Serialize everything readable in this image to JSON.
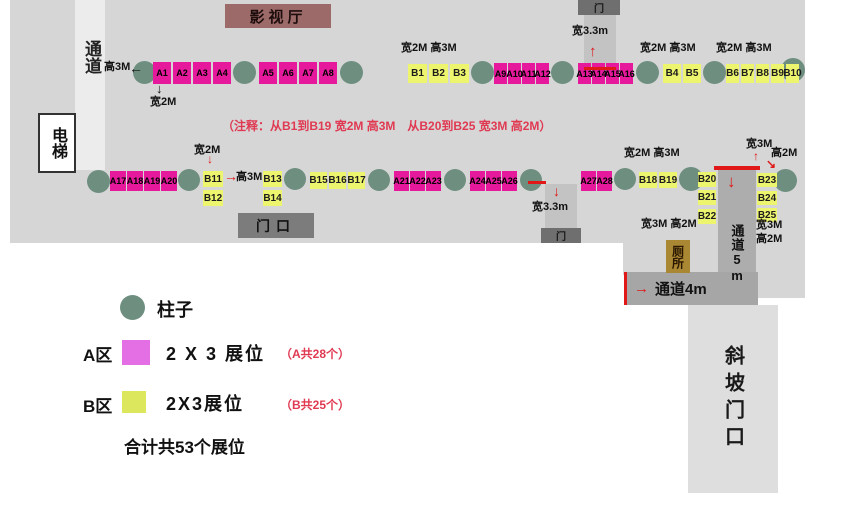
{
  "palette": {
    "booth_a": "#e6189b",
    "booth_b": "#edf46d",
    "pillar": "#6e8f80",
    "red_accent": "#e01818",
    "note_red": "#e03a52",
    "floor_gray": "#d6d6d6"
  },
  "rooms": {
    "cinema": {
      "label": "影视厅"
    },
    "elevator": {
      "label": "电梯"
    },
    "corridor_left": {
      "label": "通道"
    },
    "entrance": {
      "label": "门口"
    },
    "door_top": {
      "label": "门"
    },
    "door_bottom": {
      "label": "门"
    },
    "corridor_5m": {
      "label": "通道5m"
    },
    "corridor_4m": {
      "label": "通道4m"
    },
    "toilet": {
      "label": "厕所"
    },
    "ramp": {
      "label": "斜坡门口"
    }
  },
  "note": "（注释：从B1到B19 宽2M 高3M　从B20到B25 宽3M 高2M）",
  "legend": {
    "pillar_label": "柱子",
    "a_zone": "A区",
    "a_size": "2 X 3 展位",
    "a_count": "（A共28个）",
    "b_zone": "B区",
    "b_size": "2X3展位",
    "b_count": "（B共25个）",
    "total": "合计共53个展位"
  },
  "booths": [
    {
      "id": "A1",
      "x": 153,
      "y": 62,
      "w": 18,
      "h": 22,
      "zone": "A"
    },
    {
      "id": "A2",
      "x": 173,
      "y": 62,
      "w": 18,
      "h": 22,
      "zone": "A"
    },
    {
      "id": "A3",
      "x": 193,
      "y": 62,
      "w": 18,
      "h": 22,
      "zone": "A"
    },
    {
      "id": "A4",
      "x": 213,
      "y": 62,
      "w": 18,
      "h": 22,
      "zone": "A"
    },
    {
      "id": "A5",
      "x": 259,
      "y": 62,
      "w": 18,
      "h": 22,
      "zone": "A"
    },
    {
      "id": "A6",
      "x": 279,
      "y": 62,
      "w": 18,
      "h": 22,
      "zone": "A"
    },
    {
      "id": "A7",
      "x": 299,
      "y": 62,
      "w": 18,
      "h": 22,
      "zone": "A"
    },
    {
      "id": "A8",
      "x": 319,
      "y": 62,
      "w": 18,
      "h": 22,
      "zone": "A"
    },
    {
      "id": "B1",
      "x": 408,
      "y": 64,
      "w": 19,
      "h": 19,
      "zone": "B"
    },
    {
      "id": "B2",
      "x": 429,
      "y": 64,
      "w": 19,
      "h": 19,
      "zone": "B"
    },
    {
      "id": "B3",
      "x": 450,
      "y": 64,
      "w": 19,
      "h": 19,
      "zone": "B"
    },
    {
      "id": "A9",
      "x": 494,
      "y": 63,
      "w": 13,
      "h": 21,
      "zone": "A"
    },
    {
      "id": "A10",
      "x": 508,
      "y": 63,
      "w": 13,
      "h": 21,
      "zone": "A"
    },
    {
      "id": "A11",
      "x": 522,
      "y": 63,
      "w": 13,
      "h": 21,
      "zone": "A"
    },
    {
      "id": "A12",
      "x": 536,
      "y": 63,
      "w": 13,
      "h": 21,
      "zone": "A"
    },
    {
      "id": "A13",
      "x": 578,
      "y": 63,
      "w": 13,
      "h": 21,
      "zone": "A"
    },
    {
      "id": "A14",
      "x": 592,
      "y": 63,
      "w": 13,
      "h": 21,
      "zone": "A"
    },
    {
      "id": "A15",
      "x": 606,
      "y": 63,
      "w": 13,
      "h": 21,
      "zone": "A"
    },
    {
      "id": "A16",
      "x": 620,
      "y": 63,
      "w": 13,
      "h": 21,
      "zone": "A"
    },
    {
      "id": "B4",
      "x": 663,
      "y": 64,
      "w": 18,
      "h": 19,
      "zone": "B"
    },
    {
      "id": "B5",
      "x": 683,
      "y": 64,
      "w": 18,
      "h": 19,
      "zone": "B"
    },
    {
      "id": "B6",
      "x": 726,
      "y": 64,
      "w": 13,
      "h": 19,
      "zone": "B"
    },
    {
      "id": "B7",
      "x": 741,
      "y": 64,
      "w": 13,
      "h": 19,
      "zone": "B"
    },
    {
      "id": "B8",
      "x": 756,
      "y": 64,
      "w": 13,
      "h": 19,
      "zone": "B"
    },
    {
      "id": "B9",
      "x": 771,
      "y": 64,
      "w": 13,
      "h": 19,
      "zone": "B"
    },
    {
      "id": "B10",
      "x": 786,
      "y": 64,
      "w": 13,
      "h": 19,
      "zone": "B"
    },
    {
      "id": "A17",
      "x": 110,
      "y": 171,
      "w": 16,
      "h": 20,
      "zone": "A"
    },
    {
      "id": "A18",
      "x": 127,
      "y": 171,
      "w": 16,
      "h": 20,
      "zone": "A"
    },
    {
      "id": "A19",
      "x": 144,
      "y": 171,
      "w": 16,
      "h": 20,
      "zone": "A"
    },
    {
      "id": "A20",
      "x": 161,
      "y": 171,
      "w": 16,
      "h": 20,
      "zone": "A"
    },
    {
      "id": "B11",
      "x": 203,
      "y": 171,
      "w": 20,
      "h": 16,
      "zone": "B"
    },
    {
      "id": "B12",
      "x": 203,
      "y": 190,
      "w": 20,
      "h": 16,
      "zone": "B"
    },
    {
      "id": "B13",
      "x": 263,
      "y": 171,
      "w": 19,
      "h": 16,
      "zone": "B"
    },
    {
      "id": "B14",
      "x": 263,
      "y": 190,
      "w": 19,
      "h": 16,
      "zone": "B"
    },
    {
      "id": "B15",
      "x": 310,
      "y": 172,
      "w": 17,
      "h": 17,
      "zone": "B"
    },
    {
      "id": "B16",
      "x": 329,
      "y": 172,
      "w": 17,
      "h": 17,
      "zone": "B"
    },
    {
      "id": "B17",
      "x": 348,
      "y": 172,
      "w": 17,
      "h": 17,
      "zone": "B"
    },
    {
      "id": "A21",
      "x": 394,
      "y": 171,
      "w": 15,
      "h": 20,
      "zone": "A"
    },
    {
      "id": "A22",
      "x": 410,
      "y": 171,
      "w": 15,
      "h": 20,
      "zone": "A"
    },
    {
      "id": "A23",
      "x": 426,
      "y": 171,
      "w": 15,
      "h": 20,
      "zone": "A"
    },
    {
      "id": "A24",
      "x": 470,
      "y": 171,
      "w": 15,
      "h": 20,
      "zone": "A"
    },
    {
      "id": "A25",
      "x": 486,
      "y": 171,
      "w": 15,
      "h": 20,
      "zone": "A"
    },
    {
      "id": "A26",
      "x": 502,
      "y": 171,
      "w": 15,
      "h": 20,
      "zone": "A"
    },
    {
      "id": "A27",
      "x": 581,
      "y": 171,
      "w": 15,
      "h": 20,
      "zone": "A"
    },
    {
      "id": "A28",
      "x": 597,
      "y": 171,
      "w": 15,
      "h": 20,
      "zone": "A"
    },
    {
      "id": "B18",
      "x": 639,
      "y": 172,
      "w": 18,
      "h": 16,
      "zone": "B"
    },
    {
      "id": "B19",
      "x": 659,
      "y": 172,
      "w": 18,
      "h": 16,
      "zone": "B"
    },
    {
      "id": "B20",
      "x": 698,
      "y": 172,
      "w": 18,
      "h": 15,
      "zone": "B"
    },
    {
      "id": "B21",
      "x": 698,
      "y": 190,
      "w": 18,
      "h": 15,
      "zone": "B"
    },
    {
      "id": "B22",
      "x": 698,
      "y": 209,
      "w": 18,
      "h": 15,
      "zone": "B"
    },
    {
      "id": "B23",
      "x": 757,
      "y": 173,
      "w": 20,
      "h": 14,
      "zone": "B"
    },
    {
      "id": "B24",
      "x": 757,
      "y": 191,
      "w": 20,
      "h": 14,
      "zone": "B"
    },
    {
      "id": "B25",
      "x": 757,
      "y": 208,
      "w": 20,
      "h": 14,
      "zone": "B"
    }
  ],
  "pillars": [
    {
      "x": 133,
      "y": 61,
      "d": 23
    },
    {
      "x": 233,
      "y": 61,
      "d": 23
    },
    {
      "x": 340,
      "y": 61,
      "d": 23
    },
    {
      "x": 471,
      "y": 61,
      "d": 23
    },
    {
      "x": 551,
      "y": 61,
      "d": 23
    },
    {
      "x": 636,
      "y": 61,
      "d": 23
    },
    {
      "x": 703,
      "y": 61,
      "d": 23
    },
    {
      "x": 781,
      "y": 58,
      "d": 24
    },
    {
      "x": 87,
      "y": 170,
      "d": 23
    },
    {
      "x": 178,
      "y": 169,
      "d": 22
    },
    {
      "x": 284,
      "y": 168,
      "d": 22
    },
    {
      "x": 368,
      "y": 169,
      "d": 22
    },
    {
      "x": 444,
      "y": 169,
      "d": 22
    },
    {
      "x": 520,
      "y": 169,
      "d": 22
    },
    {
      "x": 614,
      "y": 168,
      "d": 22
    },
    {
      "x": 679,
      "y": 167,
      "d": 24
    },
    {
      "x": 774,
      "y": 169,
      "d": 23
    }
  ],
  "labels": [
    {
      "text": "高3M",
      "x": 104,
      "y": 62
    },
    {
      "text": "宽2M",
      "x": 150,
      "y": 97
    },
    {
      "text": "宽2M 高3M",
      "x": 401,
      "y": 43
    },
    {
      "text": "宽3.3m",
      "x": 572,
      "y": 26
    },
    {
      "text": "宽2M 高3M",
      "x": 640,
      "y": 43
    },
    {
      "text": "宽2M 高3M",
      "x": 716,
      "y": 43
    },
    {
      "text": "宽2M",
      "x": 194,
      "y": 145
    },
    {
      "text": "高3M",
      "x": 236,
      "y": 172
    },
    {
      "text": "宽3.3m",
      "x": 532,
      "y": 202
    },
    {
      "text": "宽2M 高3M",
      "x": 624,
      "y": 148
    },
    {
      "text": "宽3M",
      "x": 746,
      "y": 139
    },
    {
      "text": "高2M",
      "x": 771,
      "y": 148
    },
    {
      "text": "宽3M 高2M",
      "x": 641,
      "y": 219
    },
    {
      "text": "宽3M",
      "x": 756,
      "y": 220
    },
    {
      "text": "高2M",
      "x": 756,
      "y": 234
    }
  ],
  "arrows": [
    {
      "glyph": "←",
      "x": 129,
      "y": 61,
      "size": 14,
      "color": "#111111",
      "name": "left-arrow-pillar"
    },
    {
      "glyph": "↓",
      "x": 156,
      "y": 82,
      "size": 13,
      "color": "#111111",
      "name": "down-arrow-a1-width"
    },
    {
      "glyph": "↑",
      "x": 589,
      "y": 44,
      "size": 15,
      "color": "#e01818",
      "name": "up-arrow-top-door"
    },
    {
      "glyph": "↓",
      "x": 207,
      "y": 153,
      "size": 12,
      "color": "#e01818",
      "name": "down-arrow-b11-width"
    },
    {
      "glyph": "→",
      "x": 224,
      "y": 169,
      "size": 14,
      "color": "#e01818",
      "name": "right-arrow-b11-height"
    },
    {
      "glyph": "↓",
      "x": 553,
      "y": 184,
      "size": 14,
      "color": "#e01818",
      "name": "down-arrow-bottom-door"
    },
    {
      "glyph": "↓",
      "x": 727,
      "y": 173,
      "size": 17,
      "color": "#e01818",
      "name": "down-arrow-corridor5m"
    },
    {
      "glyph": "↑",
      "x": 753,
      "y": 150,
      "size": 12,
      "color": "#e01818",
      "name": "up-arrow-b23-width"
    },
    {
      "glyph": "↘",
      "x": 766,
      "y": 158,
      "size": 12,
      "color": "#e01818",
      "name": "diag-arrow-b23-height"
    }
  ],
  "lines": [
    {
      "x": 584,
      "y": 67,
      "w": 32,
      "h": 3
    },
    {
      "x": 528,
      "y": 181,
      "w": 18,
      "h": 3
    },
    {
      "x": 714,
      "y": 166,
      "w": 46,
      "h": 4
    },
    {
      "x": 624,
      "y": 272,
      "w": 3,
      "h": 33
    }
  ]
}
